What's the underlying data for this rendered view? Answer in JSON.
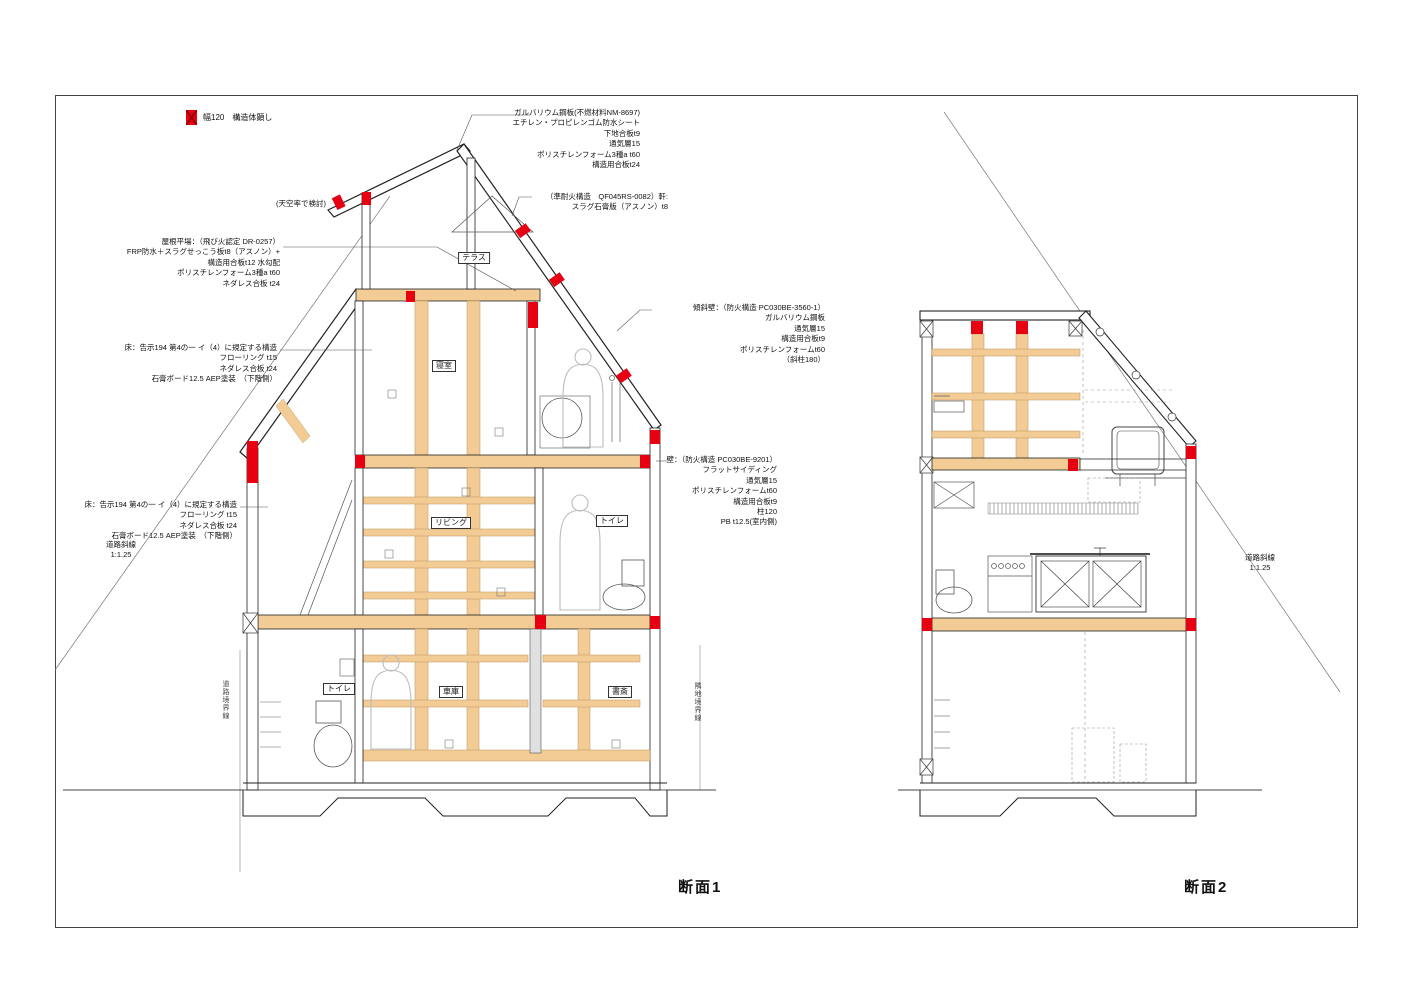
{
  "colors": {
    "red": "#e60012",
    "wood": "#f2cb95",
    "line": "#222222"
  },
  "legend": {
    "label": "幅120　構造体顕し"
  },
  "annotations": {
    "roof_spec": "ガルバリウム鋼板(不燃材料NM-8697)\nエチレン・プロピレンゴム防水シート\n下地合板t9\n通気層15\nポリスチレンフォーム3種a t60\n構造用合板t24",
    "eaves_spec": "（準耐火構造　QF045RS-0082）軒:\nスラグ石膏版（アスノン）t8",
    "sky_note": "(天空率で検討)",
    "roof_flat_spec": "屋根平場：（飛び火認定 DR-0257）\nFRP防水＋スラグせっこう板t8（アスノン）+\n構造用合板t12 水勾配\nポリスチレンフォーム3種a t60\nネダレス合板 t24",
    "floor2_spec": "床：告示194 第4の一 イ（4）に規定する構造\nフローリング t15\nネダレス合板 t24\n石膏ボード12.5 AEP塗装　（下階側）",
    "floor1_spec": "床：告示194 第4の一 イ（4）に規定する構造\nフローリング t15\nネダレス合板 t24\n石膏ボード12.5 AEP塗装　（下階側）",
    "road_slope_left": "道路斜線\n1:1.25",
    "slope_wall_spec": "傾斜壁：（防火構造 PC030BE-3560-1）\nガルバリウム鋼板\n通気層15\n構造用合板t9\nポリスチレンフォームt60\n（斜柱180）",
    "wall_spec": "壁：（防火構造 PC030BE-9201）\nフラットサイディング\n通気層15\nポリスチレンフォームt60\n構造用合板t9\n柱120\nPB t12.5(室内側)",
    "road_slope_right": "道路斜線\n1:1.25",
    "boundary_road": "道路境界線",
    "boundary_neighbor": "隣地境界線"
  },
  "rooms": {
    "terrace": "テラス",
    "bedroom": "寝室",
    "living": "リビング",
    "toilet_upper": "トイレ",
    "toilet_lower": "トイレ",
    "garage": "車庫",
    "study": "書斎"
  },
  "titles": {
    "section1": "断面1",
    "section2": "断面2"
  }
}
